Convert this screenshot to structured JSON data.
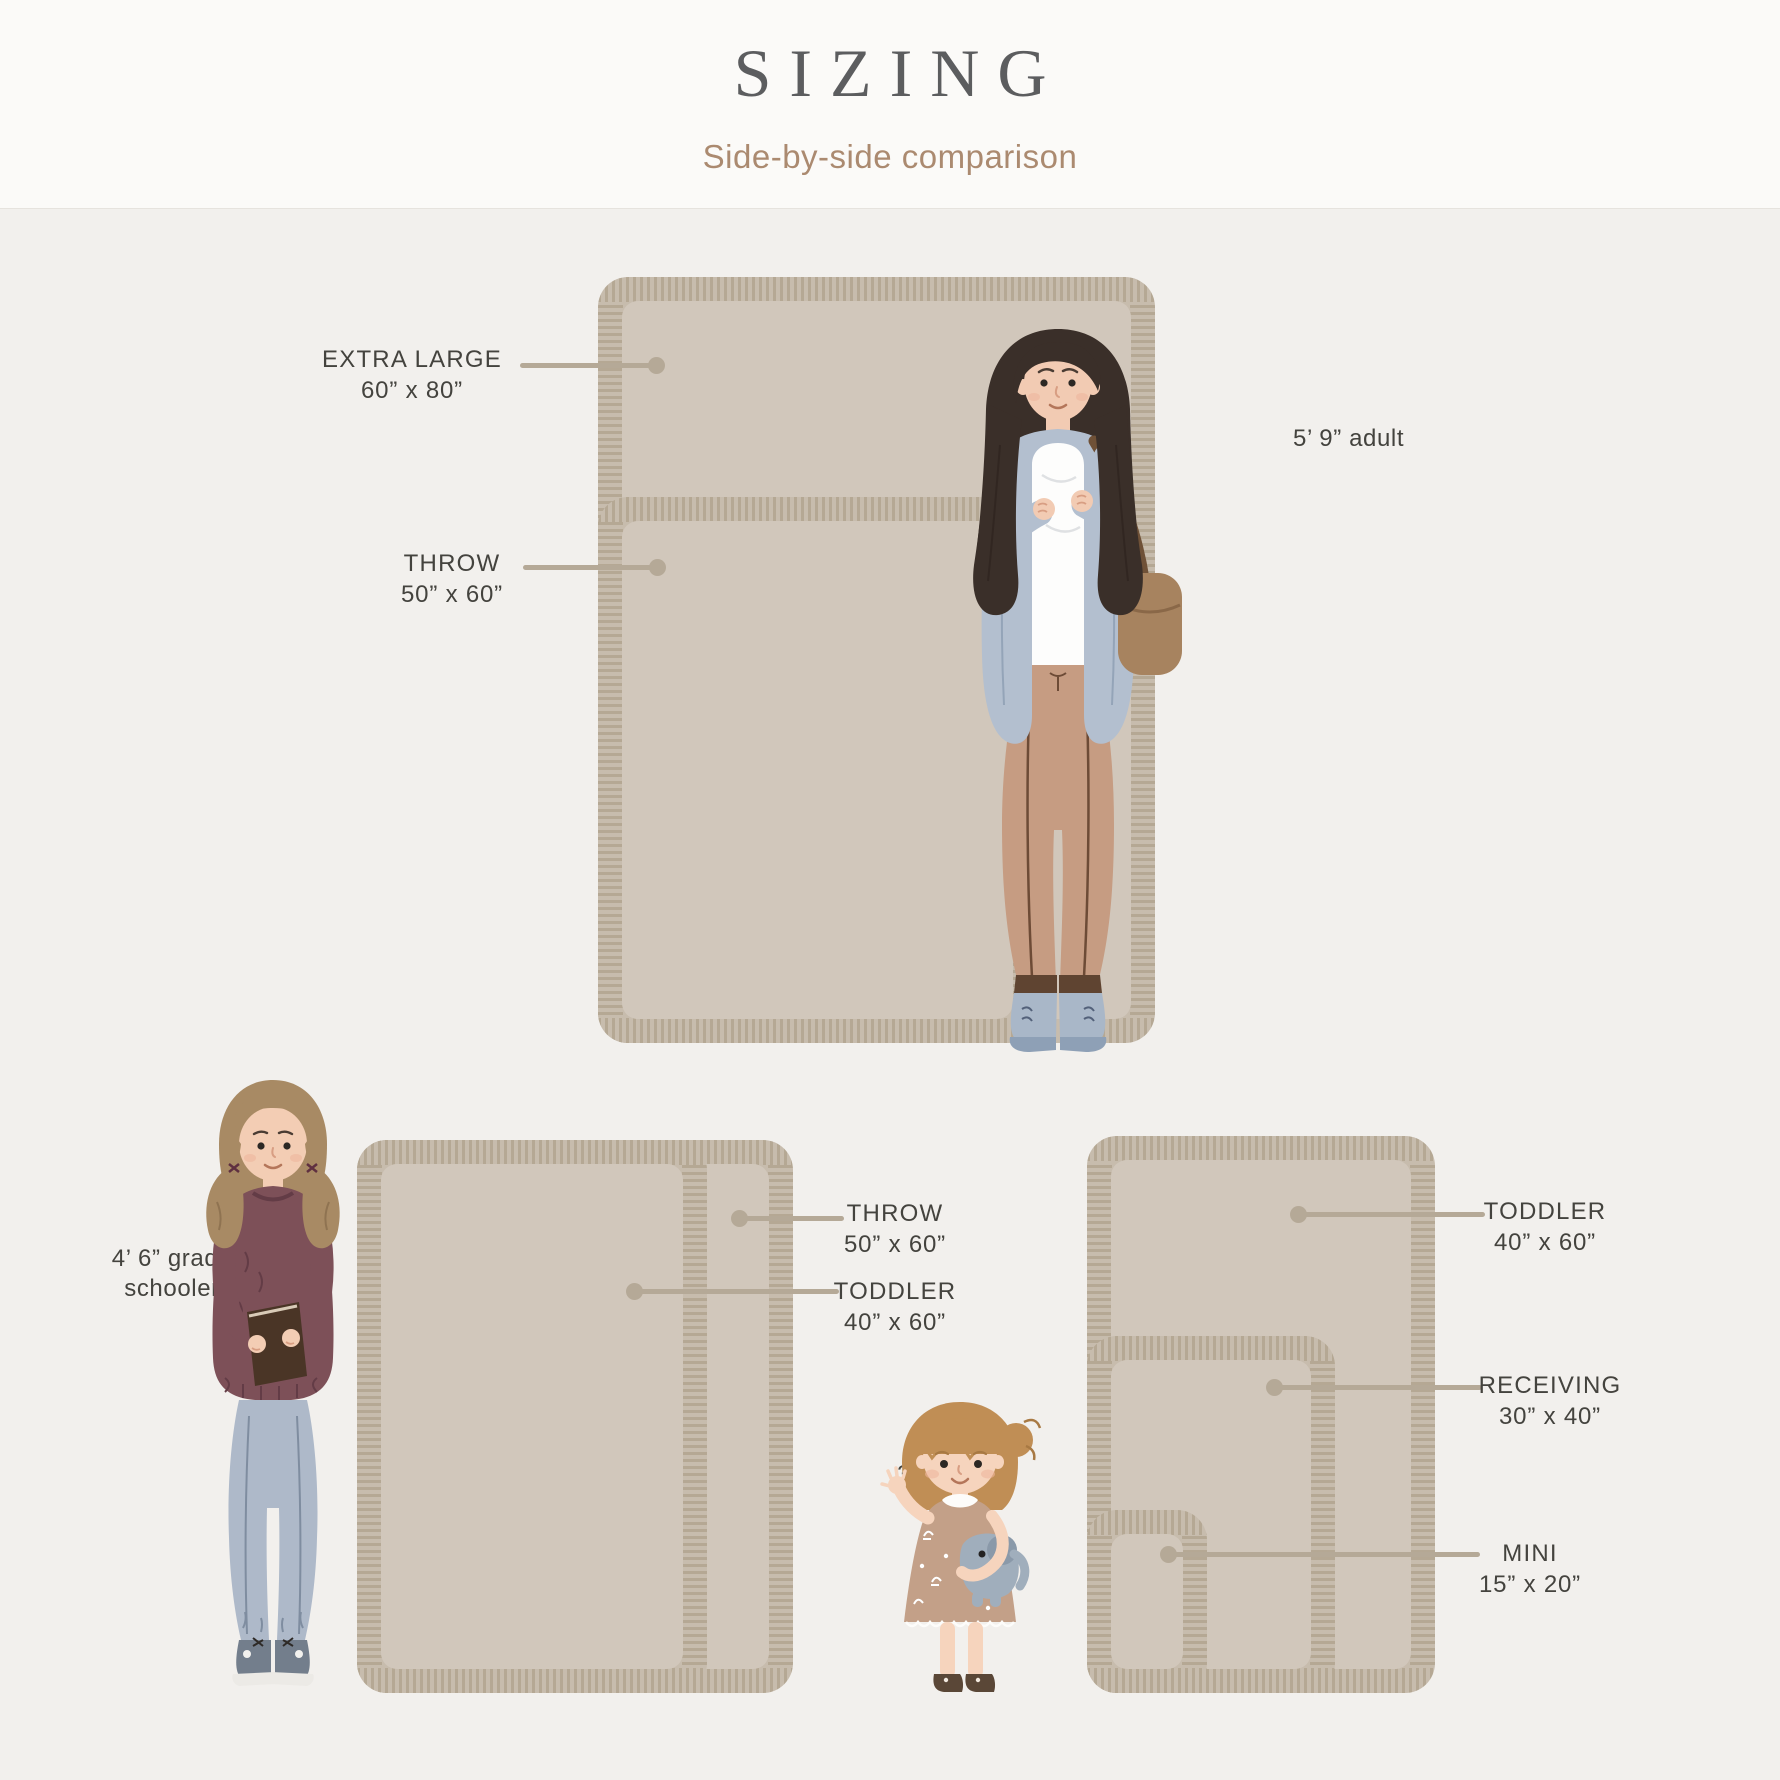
{
  "header": {
    "title": "SIZING",
    "subtitle": "Side-by-side comparison"
  },
  "groups": {
    "top": {
      "person": "5’ 9” adult",
      "labels": [
        {
          "name": "EXTRA LARGE",
          "size": "60” x 80”"
        },
        {
          "name": "THROW",
          "size": "50” x 60”"
        }
      ]
    },
    "bottom_left": {
      "person": "4’ 6” grade schooler",
      "labels": [
        {
          "name": "THROW",
          "size": "50” x 60”"
        },
        {
          "name": "TODDLER",
          "size": "40” x 60”"
        }
      ]
    },
    "bottom_right": {
      "person": "3’ toddler",
      "labels": [
        {
          "name": "TODDLER",
          "size": "40” x 60”"
        },
        {
          "name": "RECEIVING",
          "size": "30” x 40”"
        },
        {
          "name": "MINI",
          "size": "15” x 20”"
        }
      ]
    }
  },
  "colors": {
    "page_background": "#f2f0ed",
    "header_background": "#fbfaf8",
    "title_text": "#5c5d5f",
    "subtitle_text": "#ab8a70",
    "label_text": "#44433e",
    "leader_line": "#b5a997",
    "blanket_field": "#d1c7bb",
    "blanket_fringe": "#c7bcad"
  }
}
